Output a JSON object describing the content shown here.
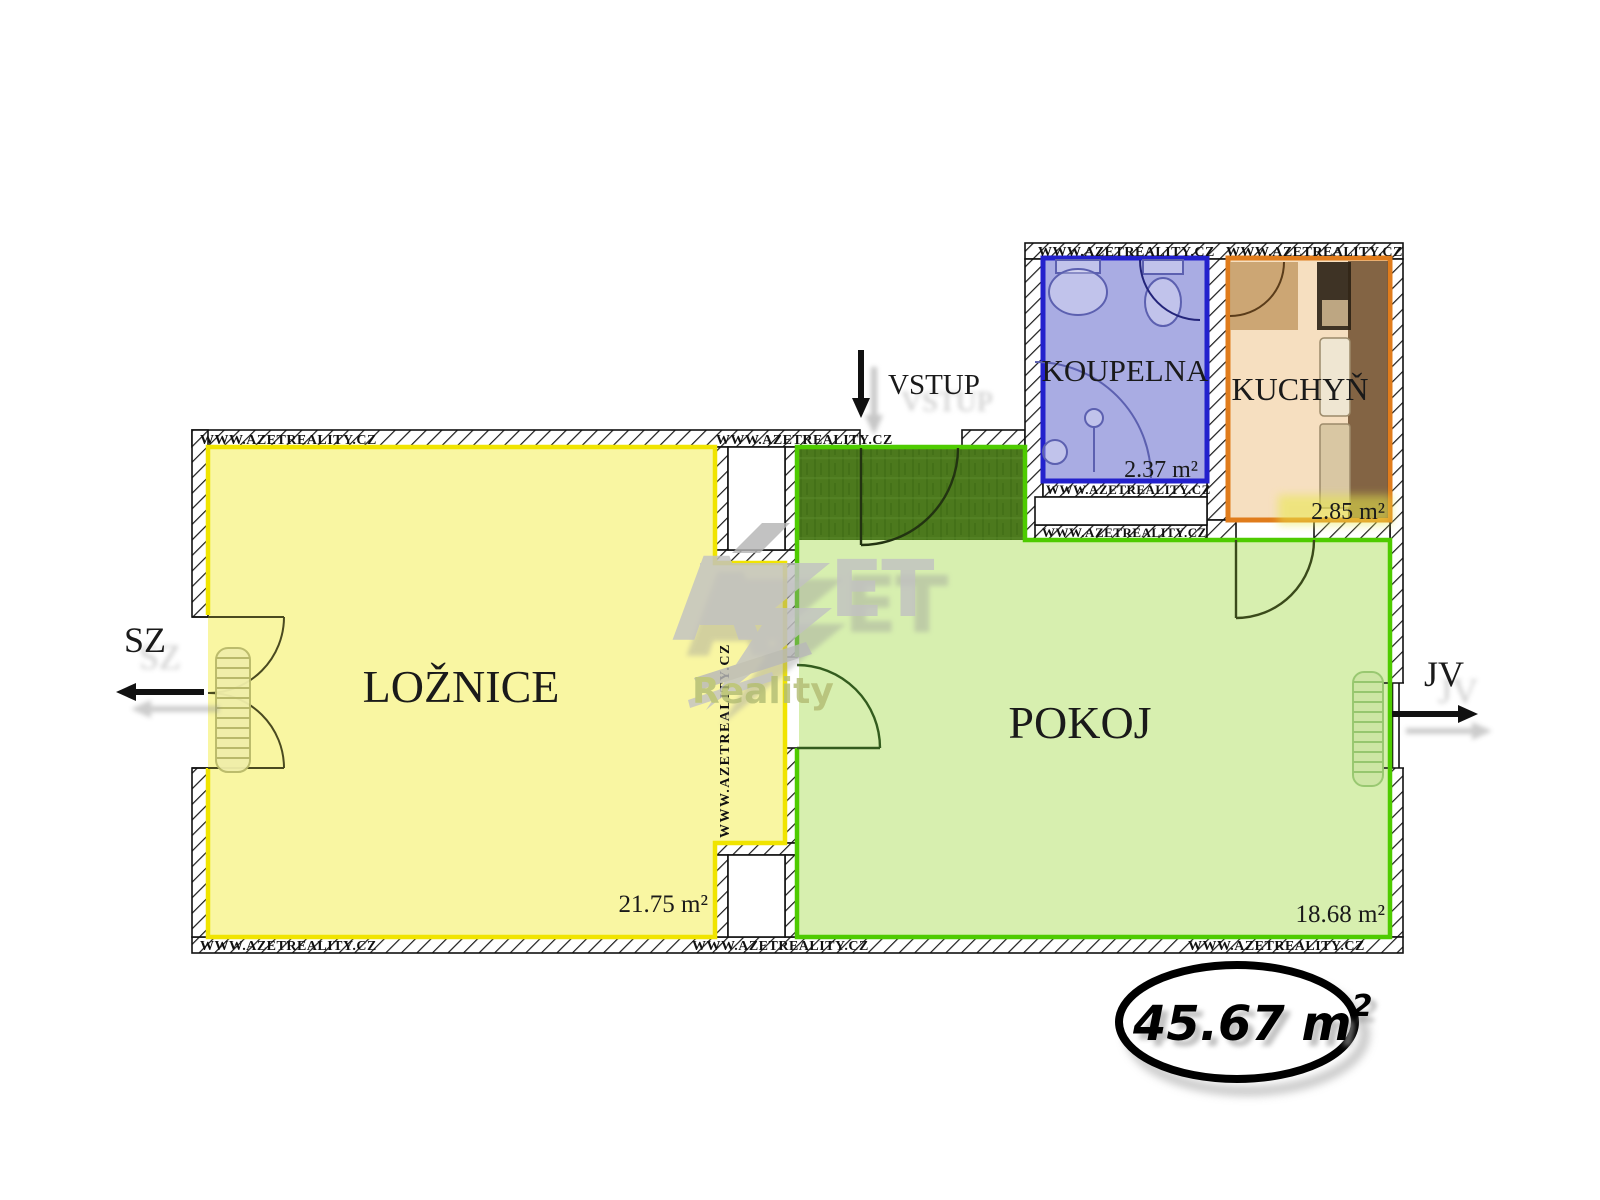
{
  "plan": {
    "entrance": {
      "label": "VSTUP"
    },
    "compass": {
      "northwest": "SZ",
      "southeast": "JV"
    },
    "total_area": {
      "text": "45.67 m²",
      "base": "45.67 m",
      "sup": "2"
    },
    "rooms": [
      {
        "name": "LOŽNICE",
        "area": "21.75 m²",
        "fill": "#f9f6a2",
        "border": "#f0e400"
      },
      {
        "name": "POKOJ",
        "area": "18.68 m²",
        "fill": "#d7efaf",
        "border": "#4ecb00",
        "entry_fill": "#4c791d"
      },
      {
        "name": "KOUPELNA",
        "area": "2.37 m²",
        "fill": "#a9ace3",
        "border": "#2321cd"
      },
      {
        "name": "KUCHYŇ",
        "area": "2.85 m²",
        "fill": "#f6dfc0",
        "border": "#e07c1c"
      }
    ],
    "watermark": {
      "brand_a": "A",
      "brand_et": "ET",
      "reality": "Reality",
      "url": "WWW.AZETREALITY.CZ"
    }
  }
}
